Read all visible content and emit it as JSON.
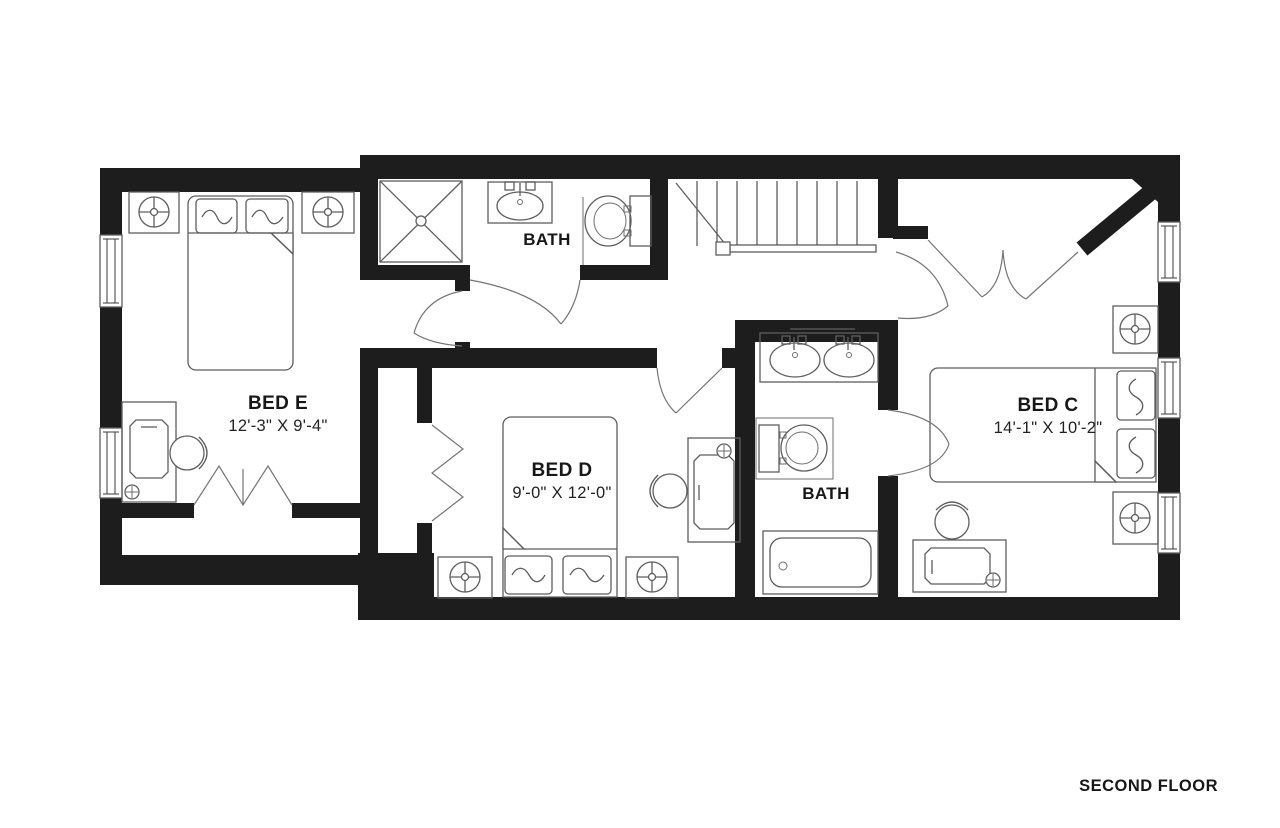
{
  "page": {
    "type": "architectural-floor-plan",
    "footer_label": "SECOND FLOOR",
    "background": "#ffffff"
  },
  "colors": {
    "wall": "#1d1d1d",
    "fixture_line": "#5e5e5e",
    "door_line": "#757575",
    "text": "#171717"
  },
  "rooms": {
    "bed_e": {
      "name": "BED E",
      "dimensions": "12'-3\" X 9'-4\"",
      "fixtures": [
        "double-bed",
        "pillow",
        "pillow",
        "nightstand-with-lamp",
        "nightstand-with-lamp",
        "desk",
        "desk-chair",
        "desk-lamp",
        "bifold-closet-doors",
        "closet",
        "window",
        "window",
        "entry-door"
      ]
    },
    "bed_d": {
      "name": "BED D",
      "dimensions": "9'-0\" X 12'-0\"",
      "fixtures": [
        "double-bed",
        "pillow",
        "pillow",
        "nightstand-with-lamp",
        "nightstand-with-lamp",
        "desk",
        "desk-chair",
        "desk-lamp",
        "bifold-closet-doors",
        "closet",
        "entry-door"
      ]
    },
    "bed_c": {
      "name": "BED C",
      "dimensions": "14'-1\" X 10'-2\"",
      "fixtures": [
        "double-bed",
        "pillow",
        "pillow",
        "nightstand-with-lamp",
        "nightstand-with-lamp",
        "desk",
        "desk-chair",
        "desk-lamp",
        "double-entry-doors",
        "window",
        "window",
        "window",
        "angled-wall"
      ]
    },
    "bath_top": {
      "name": "BATH",
      "fixtures": [
        "shower",
        "vanity-sink",
        "toilet",
        "double-doors"
      ]
    },
    "bath_mid": {
      "name": "BATH",
      "fixtures": [
        "double-vanity-two-sinks",
        "toilet",
        "bathtub",
        "door"
      ]
    },
    "hall": {
      "fixtures": [
        "staircase",
        "stair-handrail",
        "newel-post",
        "door-to-bedroom"
      ]
    }
  }
}
